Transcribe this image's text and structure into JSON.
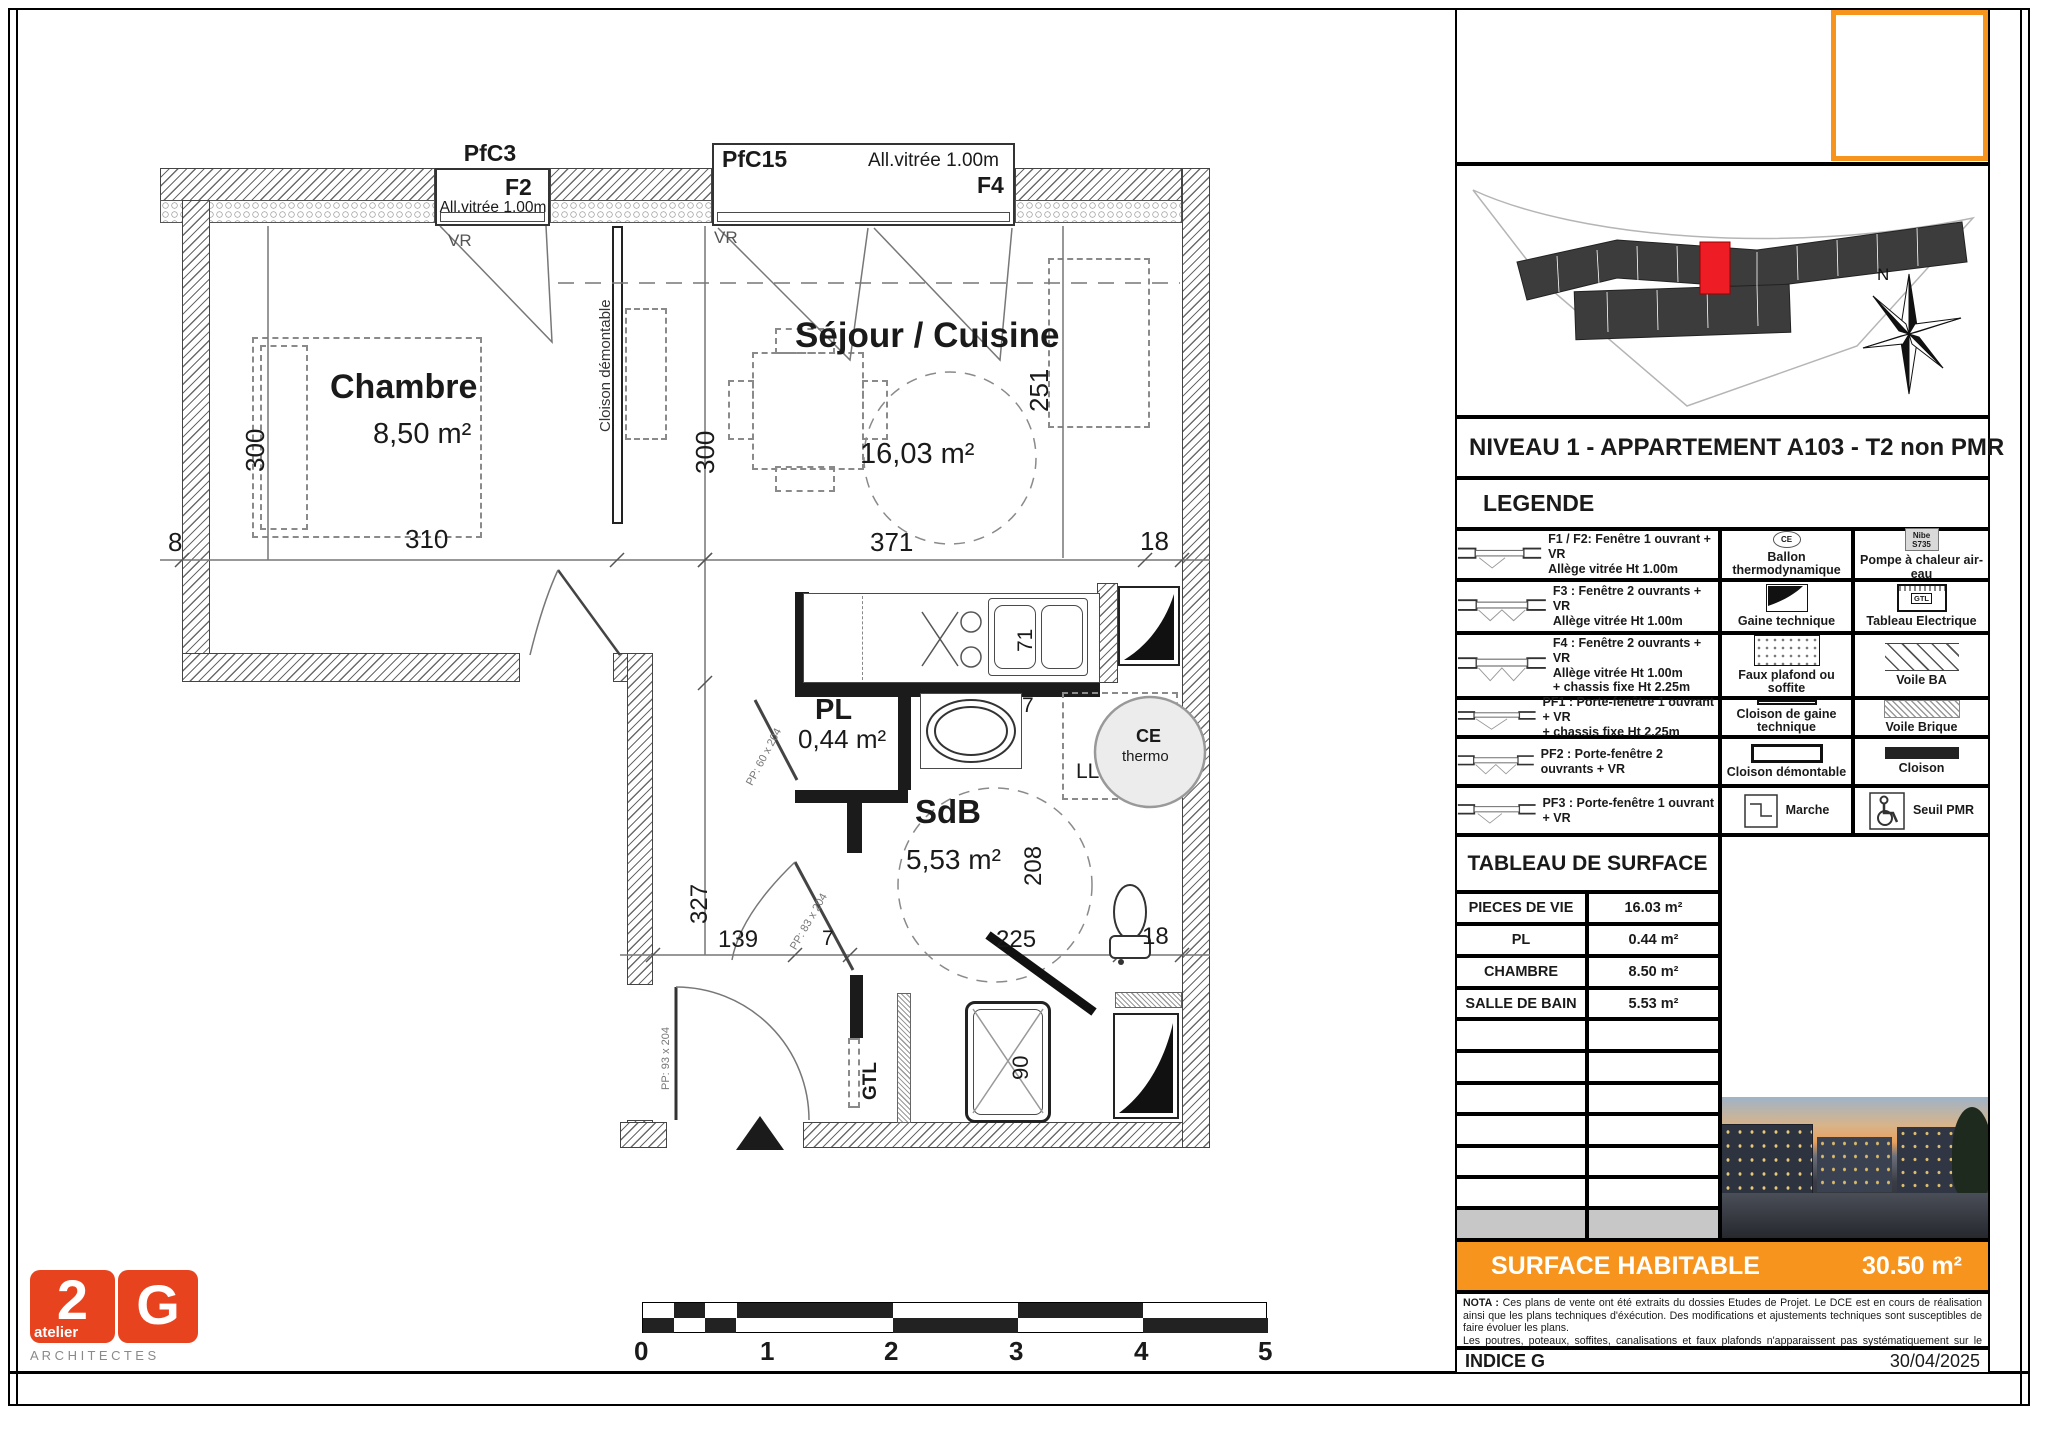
{
  "plan": {
    "window_f2": {
      "tag": "PfC3",
      "code": "F2",
      "allege": "All.vitrée 1.00m",
      "vr": "VR"
    },
    "window_f4": {
      "tag": "PfC15",
      "code": "F4",
      "allege": "All.vitrée 1.00m",
      "vr": "VR"
    },
    "rooms": {
      "chambre": {
        "name": "Chambre",
        "area": "8,50 m²"
      },
      "sejour": {
        "name": "Séjour / Cuisine",
        "area": "16,03 m²"
      },
      "pl": {
        "name": "PL",
        "area": "0,44 m²"
      },
      "sdb": {
        "name": "SdB",
        "area": "5,53 m²"
      }
    },
    "labels": {
      "cloison_demontable": "Cloison démontable",
      "ce": "CE",
      "thermo": "thermo",
      "ll": "LL",
      "gtl": "GTL",
      "door_pl": "PP: 60 x 204",
      "door_sdb": "PP: 83 x 204",
      "door_entree": "PP: 93 x 204"
    },
    "dims": {
      "d300_chambre": "300",
      "d310": "310",
      "d8": "8",
      "d300_sejour": "300",
      "d371": "371",
      "d18_sejour": "18",
      "d251": "251",
      "d71": "71",
      "d7_kitchen": "7",
      "d327": "327",
      "d139": "139",
      "d7_sdb": "7",
      "d225": "225",
      "d18_sdb": "18",
      "d208": "208",
      "d90": "90"
    },
    "scalebar": {
      "l0": "0",
      "l1": "1",
      "l2": "2",
      "l3": "3",
      "l4": "4",
      "l5": "5"
    }
  },
  "logo": {
    "two": "2",
    "g": "G",
    "atelier": "atelier",
    "name": "A R C H I T E C T E S"
  },
  "titleblock": {
    "compass_n": "N",
    "title": "NIVEAU 1 - APPARTEMENT A103 - T2 non PMR",
    "legend": {
      "heading": "LEGENDE",
      "rows": [
        {
          "c1": [
            "F1 / F2: Fenêtre 1 ouvrant + VR",
            "Allège vitrée Ht 1.00m"
          ],
          "c2": "Ballon thermodynamique",
          "c3": "Pompe à chaleur air-eau",
          "c2_icon": "CE",
          "c3_icon_1": "Nibe",
          "c3_icon_2": "S735"
        },
        {
          "c1": [
            "F3 : Fenêtre 2 ouvrants + VR",
            "Allège vitrée Ht 1.00m"
          ],
          "c2": "Gaine technique",
          "c3": "Tableau Electrique",
          "c3_icon": "GTL"
        },
        {
          "c1": [
            "F4 : Fenêtre 2 ouvrants + VR",
            "Allège vitrée Ht 1.00m",
            "+ chassis fixe Ht 2.25m"
          ],
          "c2": "Faux plafond ou soffite",
          "c3": "Voile BA"
        },
        {
          "c1": [
            "PF1 : Porte-fenêtre 1 ouvrant + VR",
            "+ chassis fixe Ht 2.25m"
          ],
          "c2": "Cloison de gaine technique",
          "c3": "Voile Brique"
        },
        {
          "c1": [
            "PF2 : Porte-fenêtre 2 ouvrants + VR"
          ],
          "c2": "Cloison démontable",
          "c3": "Cloison"
        },
        {
          "c1": [
            "PF3 : Porte-fenêtre 1 ouvrant + VR"
          ],
          "c2": "Marche",
          "c3": "Seuil PMR"
        }
      ]
    },
    "surface_table": {
      "heading": "TABLEAU DE SURFACE",
      "rows": [
        {
          "label": "PIECES DE VIE",
          "value": "16.03 m²"
        },
        {
          "label": "PL",
          "value": "0.44 m²"
        },
        {
          "label": "CHAMBRE",
          "value": "8.50 m²"
        },
        {
          "label": "SALLE DE BAIN",
          "value": "5.53 m²"
        }
      ]
    },
    "surface_habitable": {
      "label": "SURFACE HABITABLE",
      "value": "30.50 m²"
    },
    "nota_title": "NOTA :",
    "nota_p1": "Ces plans de vente ont été extraits du dossies Etudes de Projet. Le DCE est en cours de réalisation ainsi que les plans techniques d'éxécution. Des modifications et ajustements techniques sont susceptibles de faire évoluer les plans.",
    "nota_p2": "Les poutres, poteaux, soffites, canalisations et faux plafonds n'apparaissent pas systématiquement sur le présent plan. Les éléments de mobilier (meubles, appareils ménagers et plans de travail) ne sont placés qu'à titre indicatif.",
    "indice": "INDICE G",
    "date": "30/04/2025"
  },
  "colors": {
    "orange": "#F7941D",
    "logo_orange": "#E8431F",
    "unit_red": "#EE1C25"
  }
}
